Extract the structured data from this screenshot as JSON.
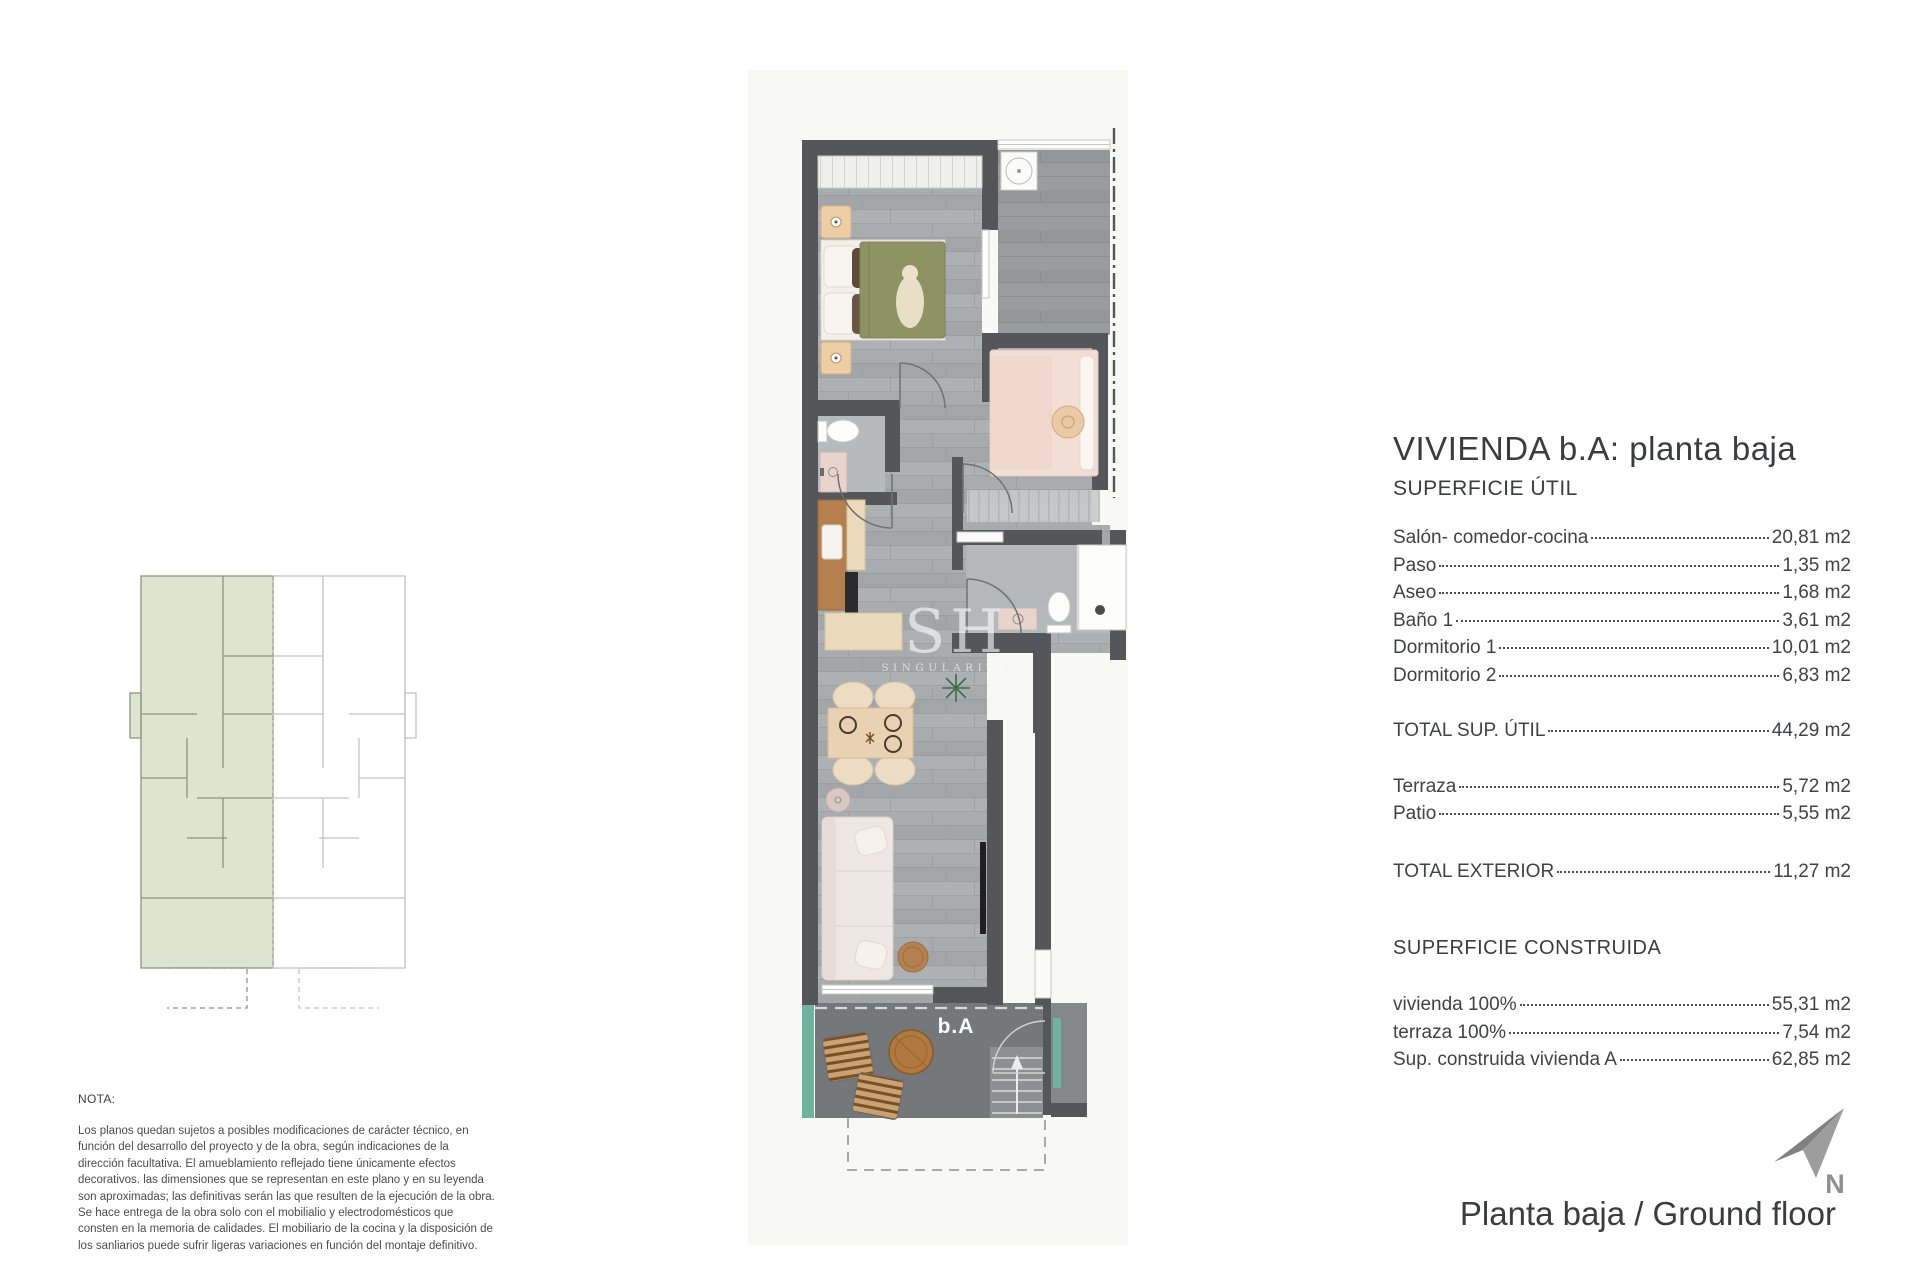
{
  "header": {
    "title": "VIVIENDA b.A: planta baja",
    "util_header": "SUPERFICIE ÚTIL"
  },
  "surfaces": {
    "util_rows": [
      {
        "label": "Salón- comedor-cocina",
        "value": "20,81 m2"
      },
      {
        "label": "Paso",
        "value": "1,35 m2"
      },
      {
        "label": "Aseo",
        "value": "1,68 m2"
      },
      {
        "label": "Baño 1",
        "value": "3,61 m2"
      },
      {
        "label": "Dormitorio 1",
        "value": "10,01 m2"
      },
      {
        "label": "Dormitorio 2",
        "value": "6,83 m2"
      }
    ],
    "total_util": {
      "label": "TOTAL SUP. ÚTIL",
      "value": "44,29 m2"
    },
    "exterior_rows": [
      {
        "label": "Terraza",
        "value": "5,72 m2"
      },
      {
        "label": "Patio",
        "value": "5,55 m2"
      }
    ],
    "total_exterior": {
      "label": "TOTAL EXTERIOR",
      "value": "11,27 m2"
    },
    "construida_header": "SUPERFICIE CONSTRUIDA",
    "construida_rows": [
      {
        "label": "vivienda 100%",
        "value": "55,31 m2"
      },
      {
        "label": "terraza 100%",
        "value": "7,54 m2"
      },
      {
        "label": "Sup. construida vivienda A",
        "value": "62,85 m2"
      }
    ]
  },
  "plan": {
    "unit_label": "b.A",
    "watermark_big": "SH",
    "watermark_small": "SINGULARITY H"
  },
  "north": {
    "label": "N"
  },
  "footer": {
    "caption": "Planta baja / Ground floor"
  },
  "note": {
    "heading": "NOTA:",
    "body": "Los planos quedan sujetos a posibles modificaciones de carácter técnico, en función del desarrollo del proyecto y de la obra, según indicaciones de la dirección facultativa. El amueblamiento reflejado tiene únicamente efectos decorativos. las dimensiones que se representan en este plano y en su leyenda son aproximadas; las definitivas serán las que resulten de la ejecución de la obra. Se hace entrega de la obra solo con el mobilialio y electrodomésticos que consten en la memoria de calidades. El mobiliario de la cocina y la disposición de los sanliarios puede sufrir ligeras variaciones en función del montaje definitivo."
  },
  "colors": {
    "wall": "#54565a",
    "floor": "#a8acaf",
    "terrace": "#74787b",
    "planter_teal": "#6fb29d",
    "keyplan_sage": "#dfe4d0",
    "olive_bed": "#8e9363",
    "text": "#3f4042"
  }
}
